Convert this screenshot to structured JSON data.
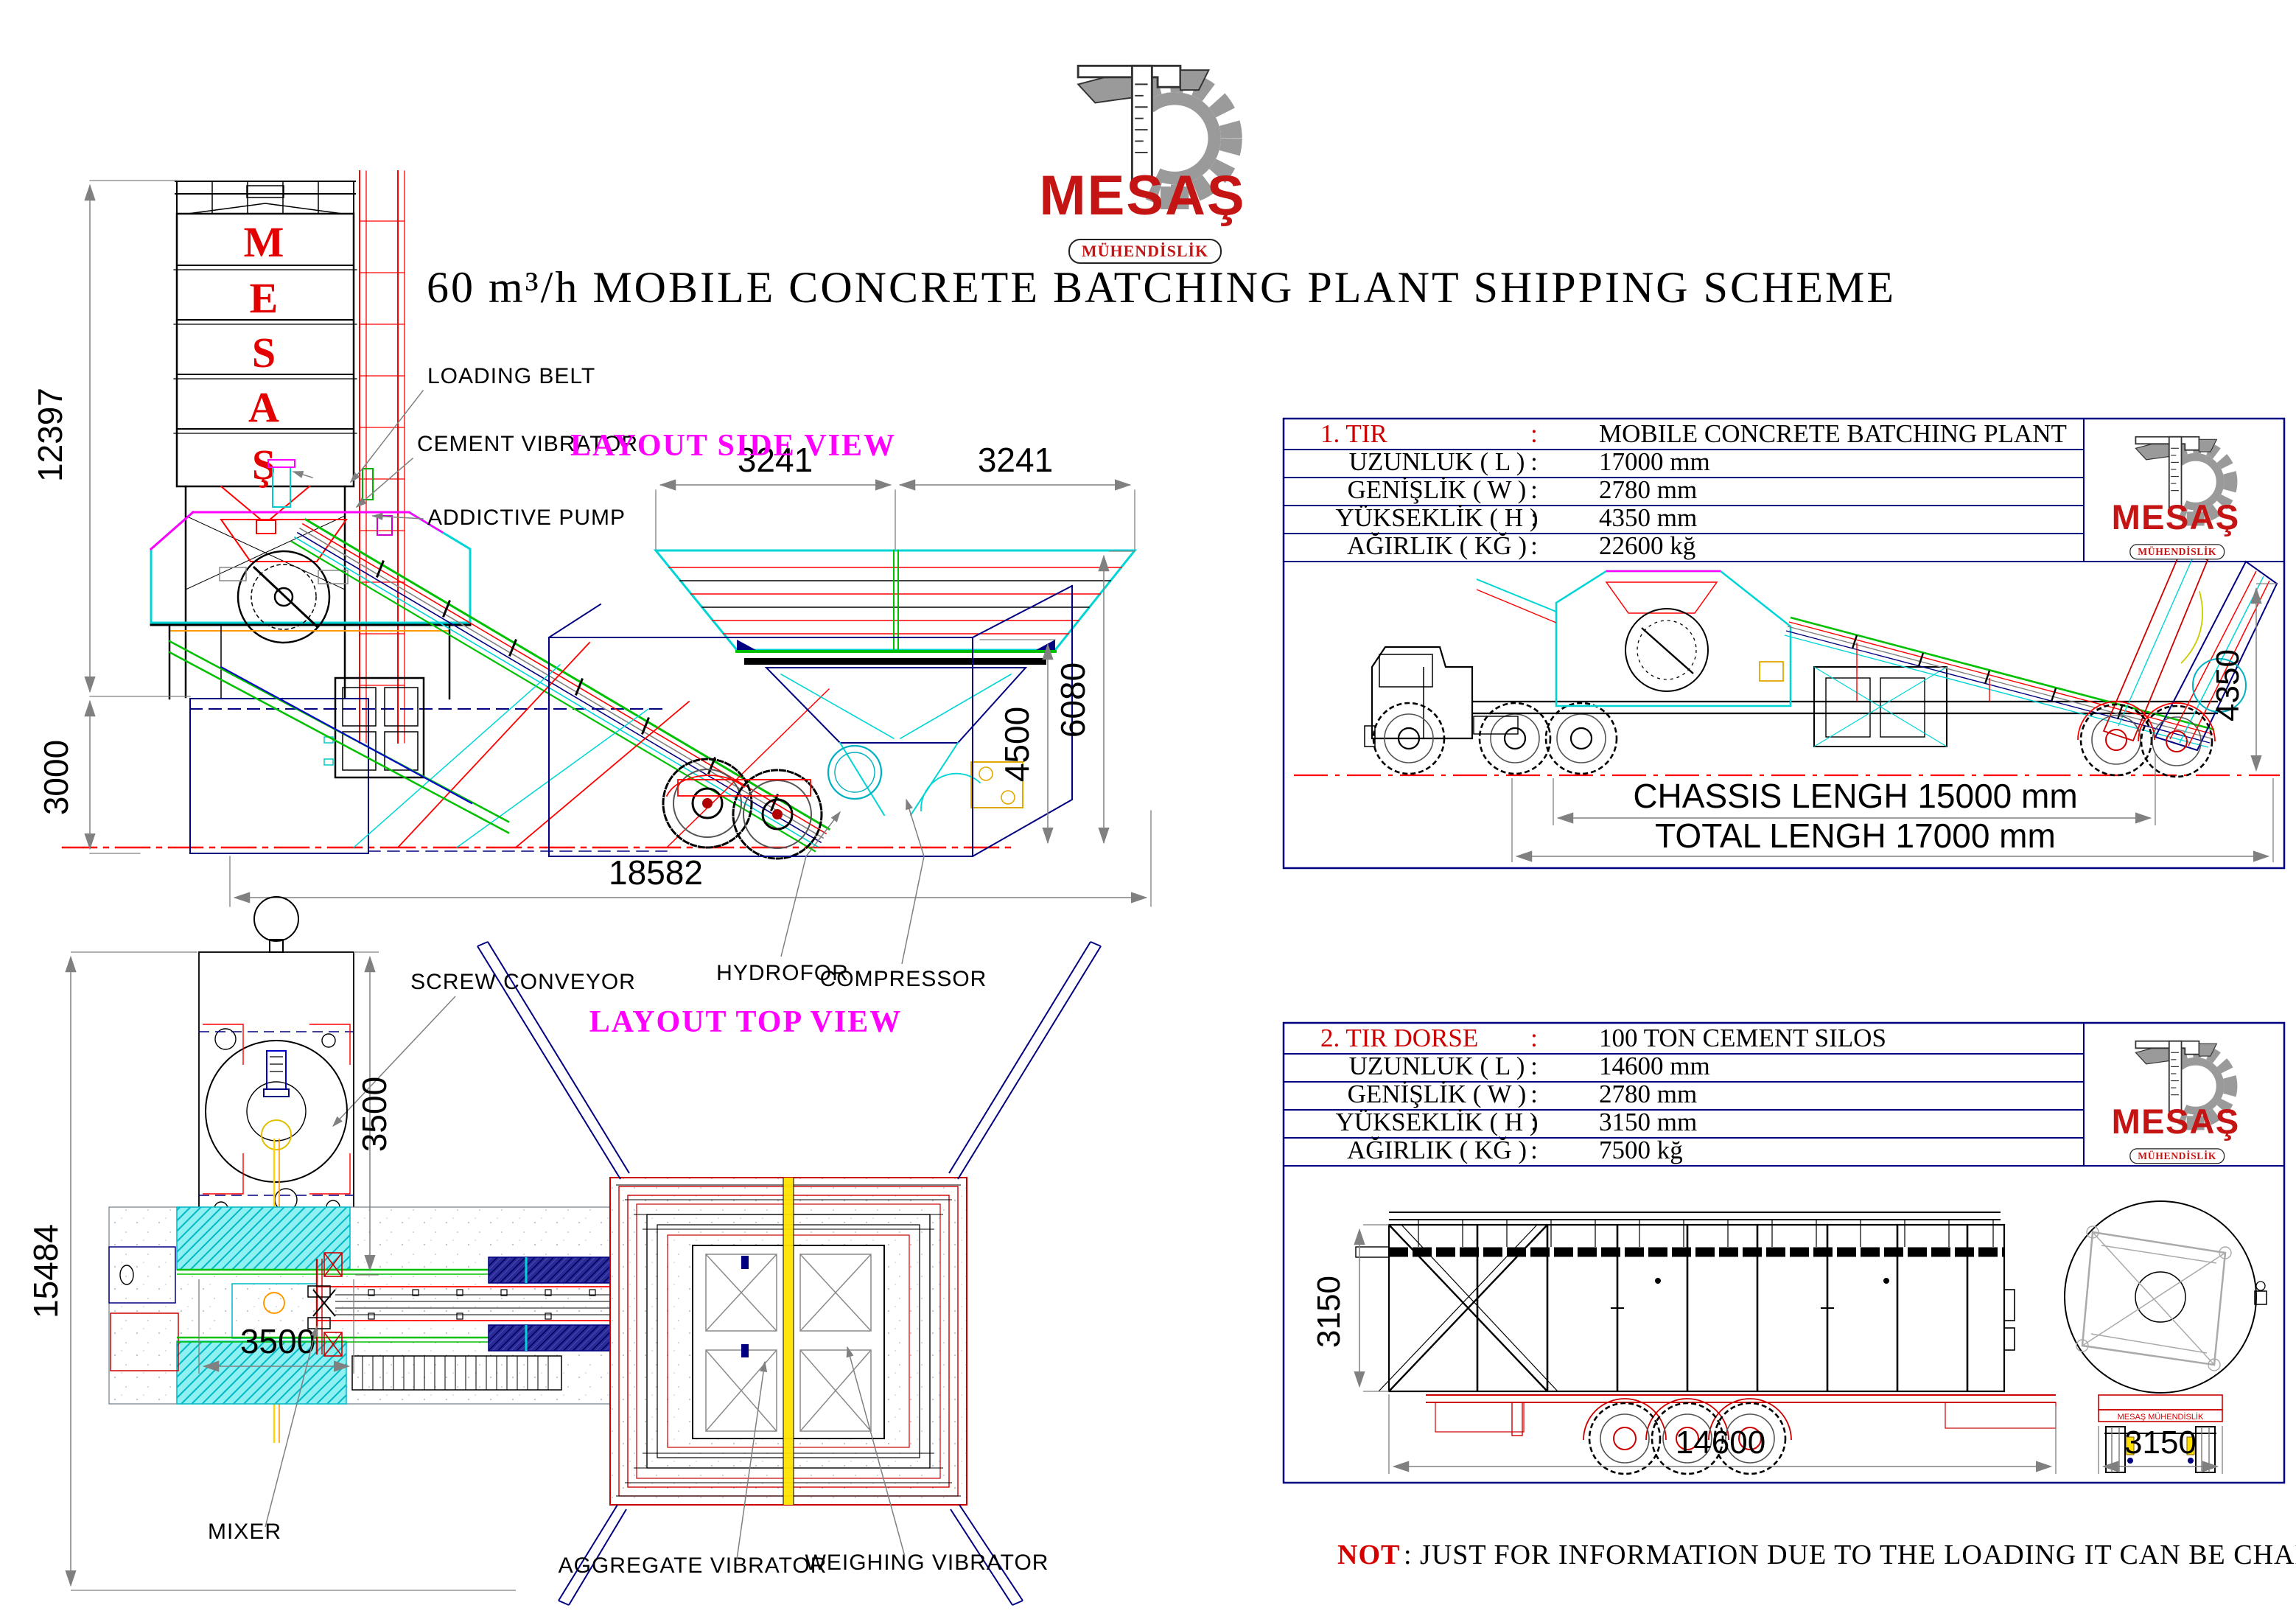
{
  "page": {
    "title": "60 m³/h MOBILE CONCRETE BATCHING PLANT SHIPPING SCHEME"
  },
  "logo": {
    "brand": "MESAŞ",
    "subtitle": "MÜHENDİSLİK"
  },
  "side_view": {
    "label": "LAYOUT SIDE VIEW",
    "silo_letters": [
      "M",
      "E",
      "S",
      "A",
      "Ş"
    ],
    "callouts": {
      "loading_belt": "LOADING BELT",
      "cement_vibrator": "CEMENT VIBRATOR",
      "addictive_pump": "ADDICTIVE PUMP",
      "screw_conveyor": "SCREW CONVEYOR",
      "hydrofor": "HYDROFOR",
      "compressor": "COMPRESSOR"
    },
    "dimensions": {
      "silo_height": "12397",
      "foundation_depth": "3000",
      "total_length": "18582",
      "bin_width_left": "3241",
      "bin_width_right": "3241",
      "hopper_height": "4500",
      "plant_height": "6080"
    }
  },
  "top_view": {
    "label": "LAYOUT TOP VIEW",
    "callouts": {
      "mixer": "MIXER",
      "aggregate_vibrator": "AGGREGATE VIBRATOR",
      "weighing_vibrator": "WEIGHING VIBRATOR"
    },
    "dimensions": {
      "silo_width": "3500",
      "silo_length": "3500",
      "plant_width": "15484"
    }
  },
  "shipment1": {
    "separator": ":",
    "header": {
      "label": "1. TIR",
      "value": "MOBILE CONCRETE BATCHING PLANT"
    },
    "rows": [
      {
        "label": "UZUNLUK ( L )",
        "value": "17000 mm"
      },
      {
        "label": "GENİŞLİK ( W )",
        "value": "2780 mm"
      },
      {
        "label": "YÜKSEKLİK ( H )",
        "value": "4350 mm"
      },
      {
        "label": "AĞIRLIK ( KĞ )",
        "value": "22600 kğ"
      }
    ],
    "dimensions": {
      "chassis_length": "CHASSIS LENGH 15000 mm",
      "total_length": "TOTAL LENGH 17000 mm",
      "height": "4350"
    }
  },
  "shipment2": {
    "separator": ":",
    "header": {
      "label": "2. TIR DORSE",
      "value": "100 TON CEMENT SILOS"
    },
    "rows": [
      {
        "label": "UZUNLUK ( L )",
        "value": "14600 mm"
      },
      {
        "label": "GENİŞLİK ( W )",
        "value": "2780 mm"
      },
      {
        "label": "YÜKSEKLİK ( H )",
        "value": "3150 mm"
      },
      {
        "label": "AĞIRLIK ( KĞ )",
        "value": "7500 kğ"
      }
    ],
    "dimensions": {
      "length": "14600",
      "height": "3150",
      "rear_width": "3150"
    },
    "chassis_brand": "MESAŞ MÜHENDİSLİK"
  },
  "note": {
    "label": "NOT",
    "text": ": JUST FOR INFORMATION DUE TO THE LOADING IT CAN BE CHANGE."
  }
}
